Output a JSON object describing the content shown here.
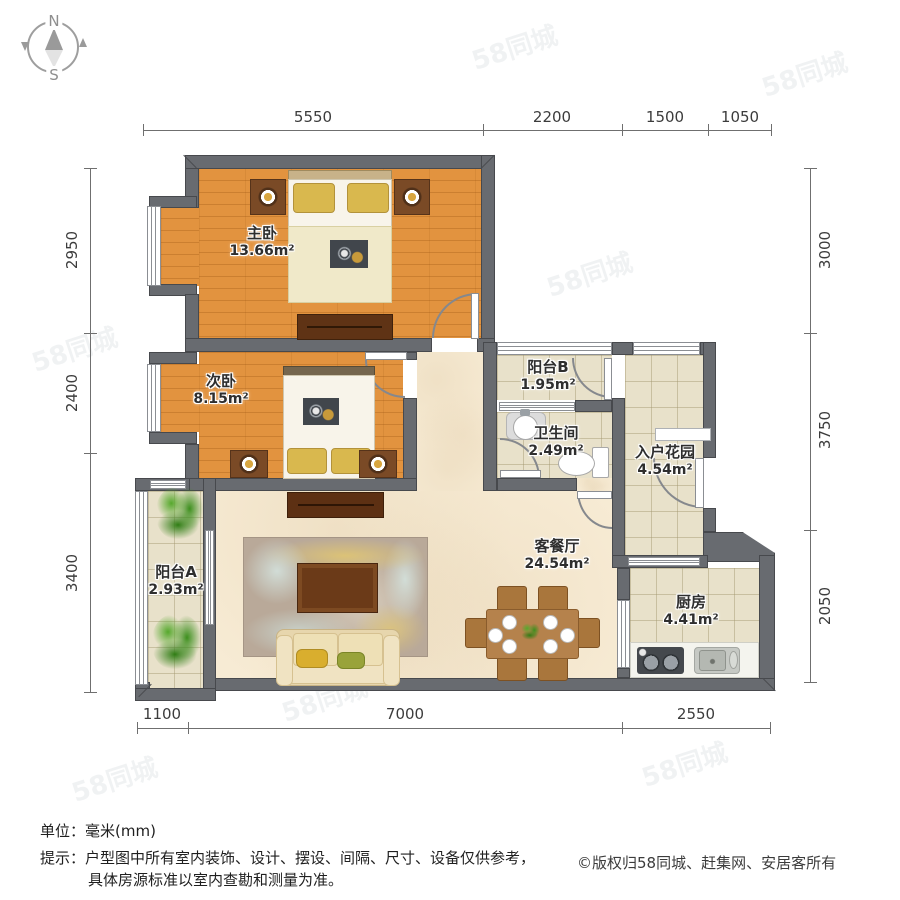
{
  "compass": {
    "north": "N",
    "south": "S"
  },
  "rooms": [
    {
      "id": "master-bedroom",
      "name": "主卧",
      "area": "13.66m²"
    },
    {
      "id": "second-bedroom",
      "name": "次卧",
      "area": "8.15m²"
    },
    {
      "id": "balcony-b",
      "name": "阳台B",
      "area": "1.95m²"
    },
    {
      "id": "bathroom",
      "name": "卫生间",
      "area": "2.49m²"
    },
    {
      "id": "entry-garden",
      "name": "入户花园",
      "area": "4.54m²"
    },
    {
      "id": "living-dining",
      "name": "客餐厅",
      "area": "24.54m²"
    },
    {
      "id": "kitchen",
      "name": "厨房",
      "area": "4.41m²"
    },
    {
      "id": "balcony-a",
      "name": "阳台A",
      "area": "2.93m²"
    }
  ],
  "dimensions": {
    "top": [
      "5550",
      "2200",
      "1500",
      "1050"
    ],
    "left": [
      "2950",
      "2400",
      "3400"
    ],
    "right": [
      "3000",
      "3750",
      "2050"
    ],
    "bottom": [
      "1100",
      "7000",
      "2550"
    ]
  },
  "footer": {
    "unit_label": "单位：毫米(mm)",
    "tip_line1": "提示：户型图中所有室内装饰、设计、摆设、间隔、尺寸、设备仅供参考，",
    "tip_line2": "具体房源标准以室内查勘和测量为准。",
    "copyright": "©版权归58同城、赶集网、安居客所有"
  },
  "watermark": {
    "text": "58同城"
  },
  "colors": {
    "wall": "#686b70",
    "wood_floor": "#e2933f",
    "tile_floor": "#e8e1ca",
    "living_floor": "#f7ebd4",
    "furniture_dark": "#5d3013",
    "pillow_gold": "#d9b84e"
  }
}
